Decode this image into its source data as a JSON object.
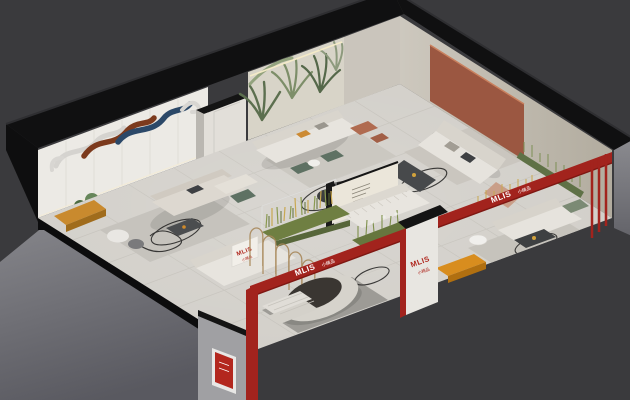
{
  "scene": {
    "title": "MLIS sofa showroom — isometric 3D cutaway floor-plan render",
    "background_color": "#3a3a3d"
  },
  "brand": {
    "name": "MLIS",
    "sub_label_cn": "小精品"
  },
  "signage": {
    "front_beam": {
      "brand": "MLIS",
      "sub": "小精品"
    },
    "right_beam": {
      "brand": "MLIS",
      "sub": "小精品"
    },
    "entry_pillar": {
      "brand": "MLIS",
      "sub": "小精品"
    },
    "sofa_sign": {
      "brand": "MLIS",
      "sub": "小精品"
    }
  },
  "areas": [
    "marble art feature-wall lounge",
    "palm mural sofa lounge",
    "terracotta panel lounge",
    "central aisle with dried-grass display cases",
    "channel-tufted sofa display",
    "arched bronze screen partition",
    "round platform daybed with slatted bench",
    "front-right sofa room",
    "MLIS entry pillar and red signage beams"
  ],
  "palette": {
    "background": "#3a3a3d",
    "cut_wall_black": "#101011",
    "exterior_wall_gray": "#7d7d81",
    "floor_tile": "#d2cfc9",
    "marble_wall": "#eceae5",
    "palm_mural_base": "#d8d4c8",
    "ne_wall": "#c2bcb2",
    "terracotta_panel": "#9b5741",
    "accent_red": "#a2231d",
    "brand_red_text": "#b0281f",
    "sofa_white": "#e7e4de",
    "green_chair": "#5e7163",
    "grass_green": "#8a9a50",
    "grass_gold": "#c9a851",
    "mustard_bench": "#c98a2e",
    "orange_bench": "#d88d1e",
    "art_blue": "#2b4868",
    "art_rust": "#7c3a1d"
  }
}
